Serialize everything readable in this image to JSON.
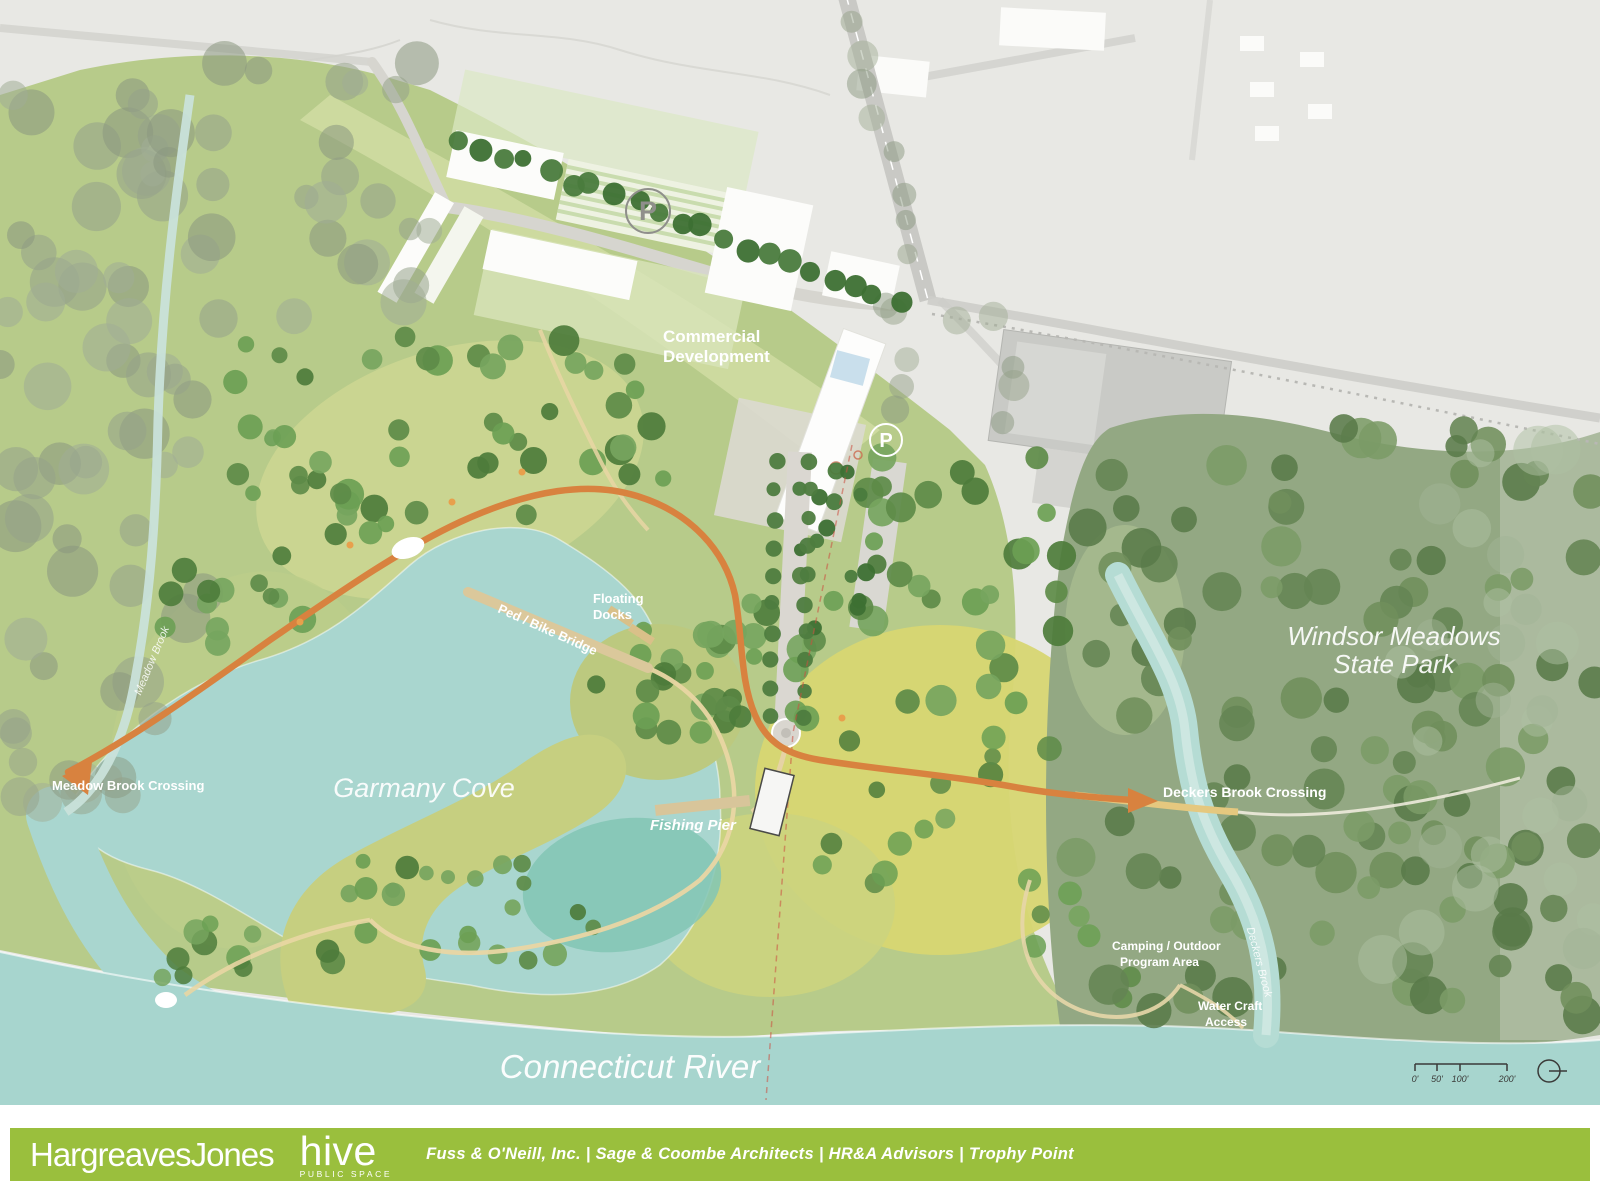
{
  "map": {
    "labels": {
      "commercial": [
        "Commercial",
        "Development"
      ],
      "garmany_cove": "Garmany Cove",
      "connecticut_river": "Connecticut River",
      "windsor_meadows": [
        "Windsor Meadows",
        "State Park"
      ],
      "meadow_brook_crossing": "Meadow Brook Crossing",
      "deckers_brook_crossing": "Deckers Brook Crossing",
      "floating_docks": [
        "Floating",
        "Docks"
      ],
      "ped_bike_bridge": "Ped / Bike Bridge",
      "fishing_pier": "Fishing Pier",
      "camping": [
        "Camping / Outdoor",
        "Program Area"
      ],
      "water_craft": [
        "Water Craft",
        "Access"
      ],
      "meadow_brook": "Meadow Brook",
      "deckers_brook": "Deckers Brook",
      "parking_symbol": "P"
    },
    "scale_bar": {
      "ticks": [
        "0'",
        "50'",
        "100'",
        "200'"
      ]
    },
    "colors": {
      "river": "#a7d5ce",
      "meadow": "#b7cb8a",
      "forest": "#93a883",
      "trail_orange": "#d8823f",
      "context_gray": "#e8e8e4",
      "footer_green": "#9abf3d"
    }
  },
  "footer": {
    "logo_primary": "HargreavesJones",
    "logo_secondary": "hive",
    "logo_secondary_sub": "PUBLIC SPACE",
    "credits": "Fuss & O'Neill, Inc. | Sage & Coombe Architects | HR&A Advisors | Trophy Point"
  }
}
